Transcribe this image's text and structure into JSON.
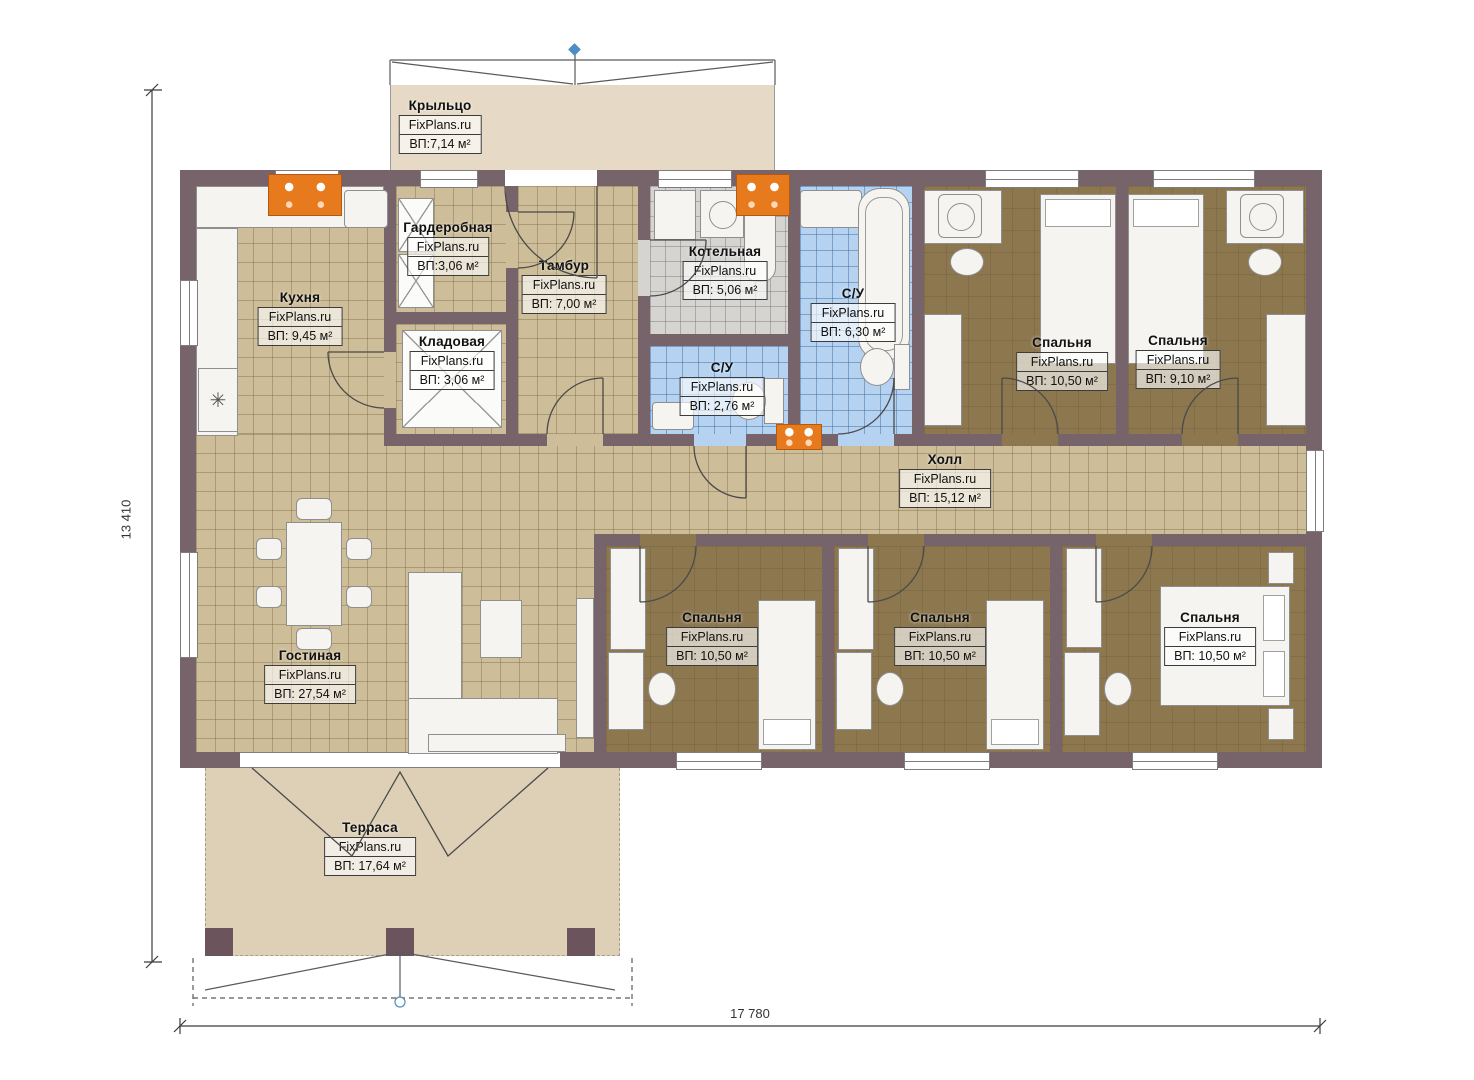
{
  "brand": "FixPlans.ru",
  "plan_type": "single-storey house floor plan",
  "dimensions": {
    "width": "17 780",
    "height": "13 410"
  },
  "rooms": {
    "porch": {
      "name": "Крыльцо",
      "area": "ВП:7,14 м²"
    },
    "wardrobe": {
      "name": "Гардеробная",
      "area": "ВП:3,06 м²"
    },
    "vestibule": {
      "name": "Тамбур",
      "area": "ВП: 7,00 м²"
    },
    "boiler": {
      "name": "Котельная",
      "area": "ВП: 5,06 м²"
    },
    "bathroom": {
      "name": "С/У",
      "area": "ВП: 6,30 м²"
    },
    "kitchen": {
      "name": "Кухня",
      "area": "ВП: 9,45 м²"
    },
    "pantry": {
      "name": "Кладовая",
      "area": "ВП: 3,06 м²"
    },
    "wc": {
      "name": "С/У",
      "area": "ВП: 2,76 м²"
    },
    "bedroom_top_1": {
      "name": "Спальня",
      "area": "ВП: 10,50 м²"
    },
    "bedroom_top_2": {
      "name": "Спальня",
      "area": "ВП: 9,10 м²"
    },
    "hall": {
      "name": "Холл",
      "area": "ВП: 15,12 м²"
    },
    "living": {
      "name": "Гостиная",
      "area": "ВП: 27,54 м²"
    },
    "bedroom_bottom_1": {
      "name": "Спальня",
      "area": "ВП: 10,50 м²"
    },
    "bedroom_bottom_2": {
      "name": "Спальня",
      "area": "ВП: 10,50 м²"
    },
    "bedroom_bottom_3": {
      "name": "Спальня",
      "area": "ВП: 10,50 м²"
    },
    "terrace": {
      "name": "Терраса",
      "area": "ВП: 17,64 м²"
    }
  },
  "colors": {
    "wall": "#77636a",
    "tile_beige": "#cdbd98",
    "floor_brown": "#8c774f",
    "tile_blue": "#b5d3f0",
    "tile_gray": "#d6d4d1",
    "deck_tan": "#ddd0b7",
    "accent_orange": "#e87a1e",
    "marker_blue": "#4d8fc4"
  }
}
